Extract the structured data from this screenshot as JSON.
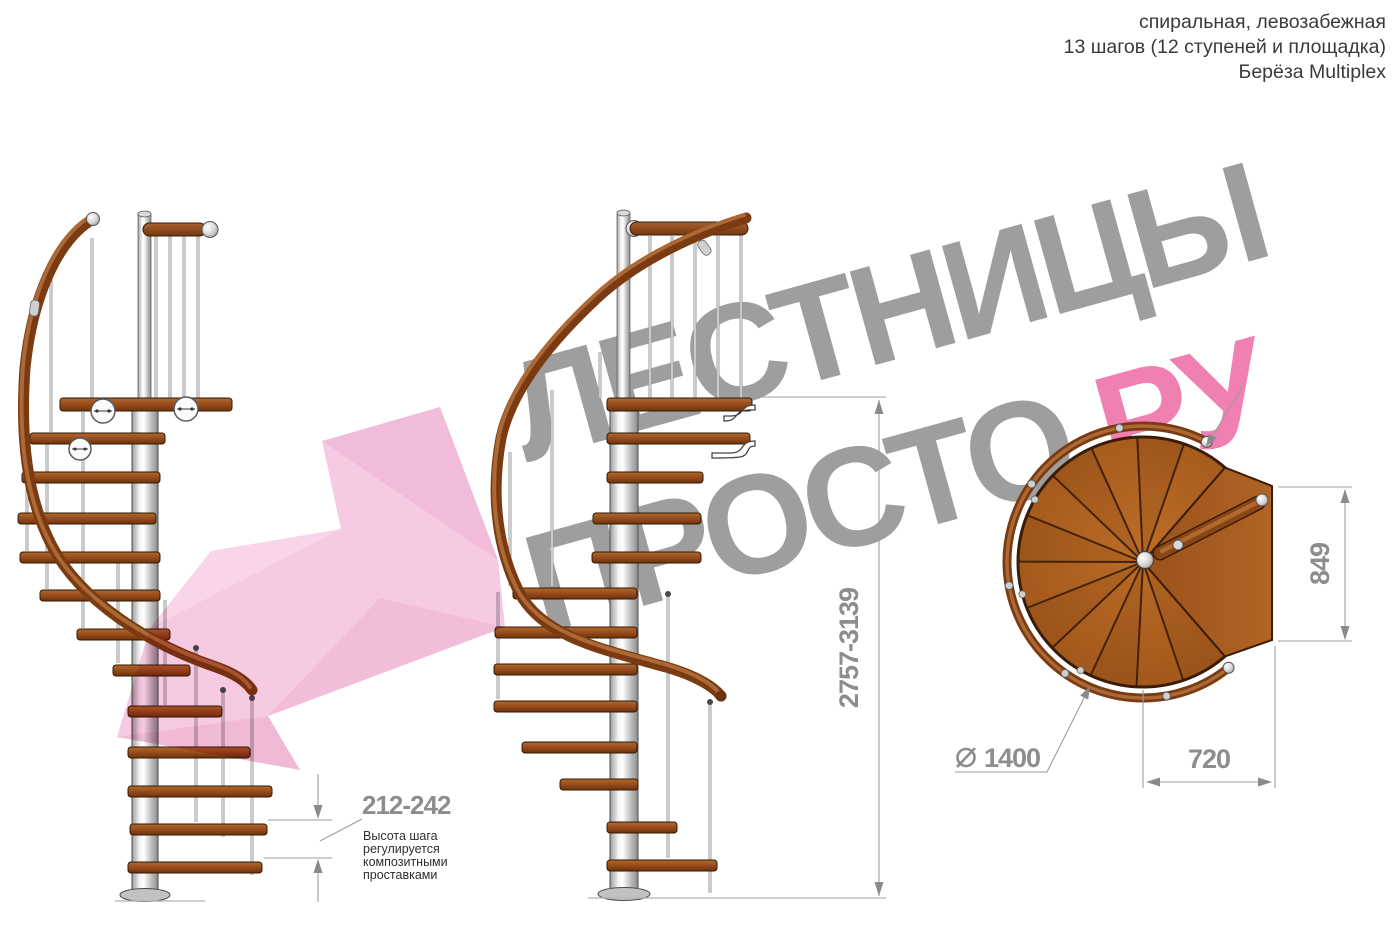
{
  "header": {
    "lines": [
      "спиральная, левозабежная",
      "13 шагов (12 ступеней и площадка)",
      "Берёза Multiplex"
    ]
  },
  "watermark": {
    "word1": "ЛЕСТНИЦЫ",
    "word2": "ПРОСТО",
    "word2_suffix": ".РУ",
    "text_color": "#9e9e9e",
    "suffix_color": "#f080b2",
    "arrow_color": "#f5bddc"
  },
  "dimensions": {
    "total_height": "2757-3139",
    "step_height": "212-242",
    "plan_width": "849",
    "plan_depth": "720",
    "diameter": "1400"
  },
  "note": {
    "lines": [
      "Высота шага",
      "регулируется",
      "композитными",
      "проставками"
    ]
  },
  "colors": {
    "dimension_text": "#8d8d8d",
    "header_text": "#3a3a3a",
    "wood": "#a0561b",
    "handrail": "#7a3b12",
    "pole": "#c9c9c9"
  }
}
